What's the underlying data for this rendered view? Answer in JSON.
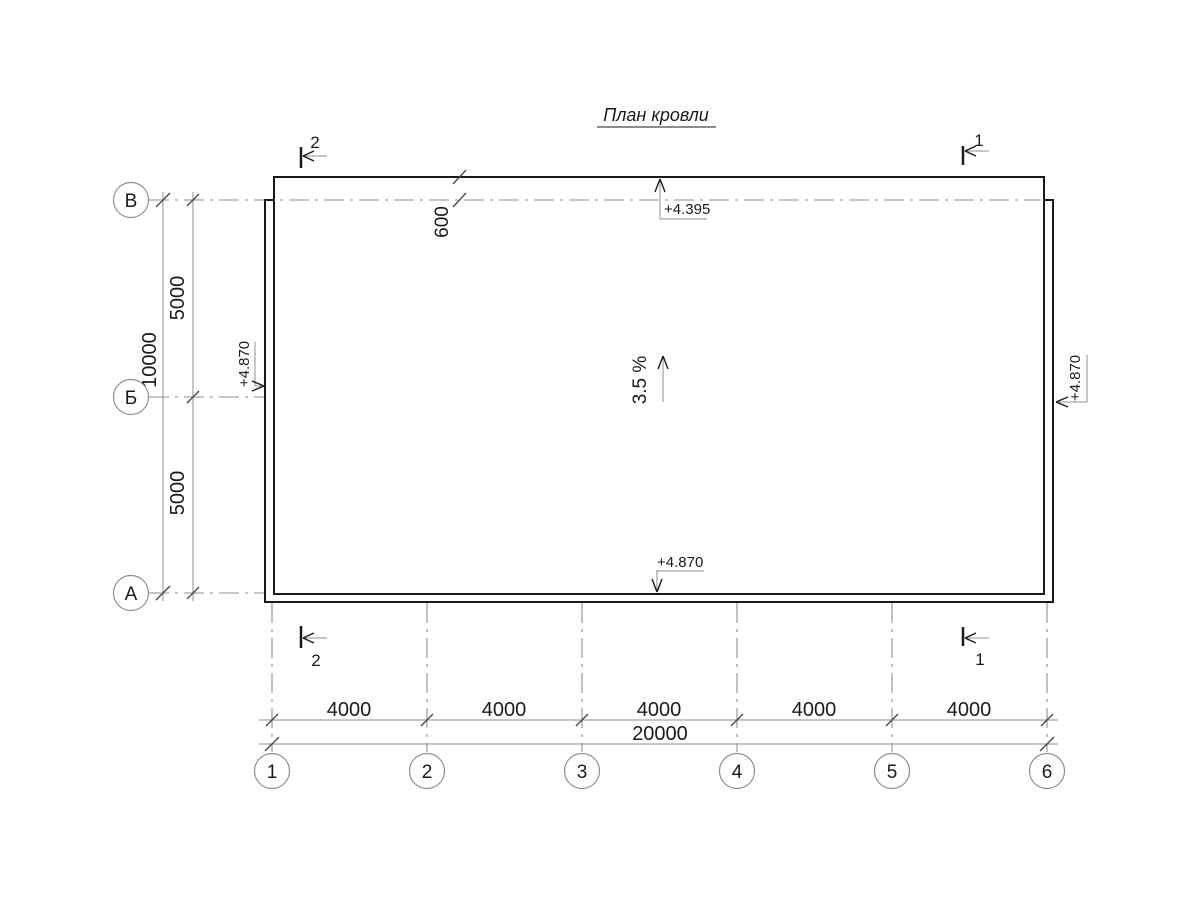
{
  "title": "План кровли",
  "colors": {
    "line_dark": "#1a1a1a",
    "line_gray": "#8f8f8f",
    "background": "#ffffff"
  },
  "axes": {
    "horizontal": [
      {
        "label": "В"
      },
      {
        "label": "Б"
      },
      {
        "label": "А"
      }
    ],
    "vertical": [
      {
        "label": "1"
      },
      {
        "label": "2"
      },
      {
        "label": "3"
      },
      {
        "label": "4"
      },
      {
        "label": "5"
      },
      {
        "label": "6"
      }
    ]
  },
  "dimensions": {
    "left": {
      "segments": [
        "5000",
        "5000"
      ],
      "total": "10000"
    },
    "bottom": {
      "segments": [
        "4000",
        "4000",
        "4000",
        "4000",
        "4000"
      ],
      "total": "20000"
    },
    "eave_offset": "600"
  },
  "elevations": {
    "top": "+4.395",
    "bottom": "+4.870",
    "left": "+4.870",
    "right": "+4.870"
  },
  "slope": "3.5 %",
  "section_marks": {
    "mark_1": "1",
    "mark_2": "2"
  }
}
